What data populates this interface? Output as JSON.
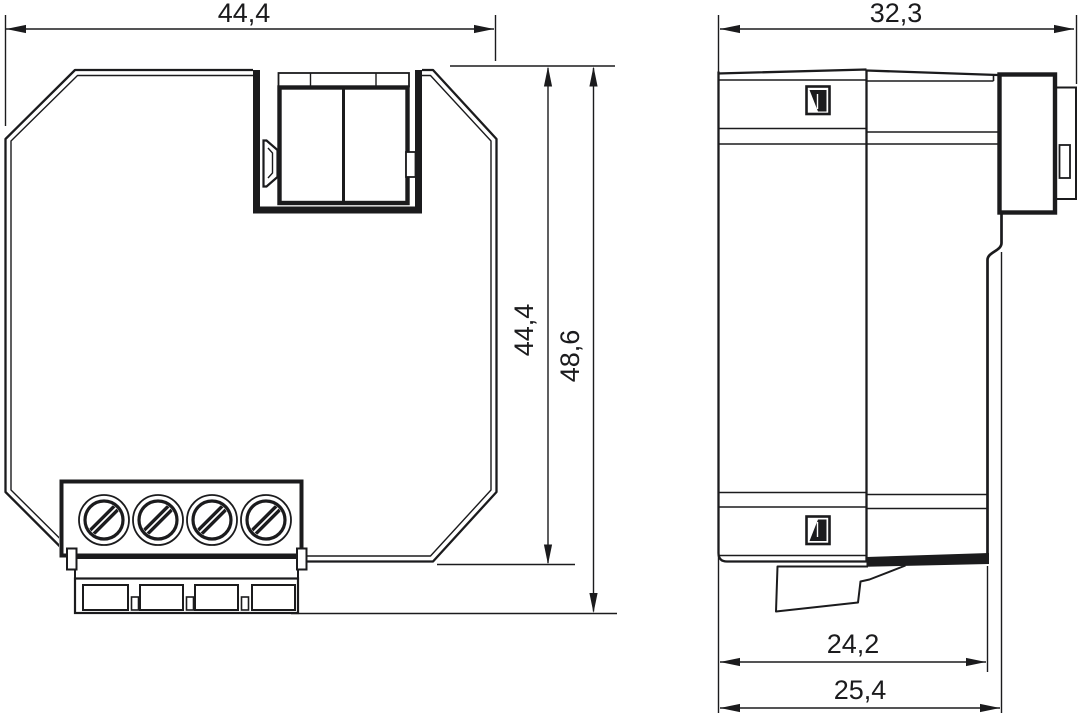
{
  "drawing": {
    "type": "technical-dimension-drawing",
    "views": {
      "front_view": {
        "description": "flush-mount device, octagonal housing with 4-screw terminal block and bus connector recess",
        "dim_width": "44,4",
        "dim_height": "44,4",
        "dim_total_height": "48,6"
      },
      "side_view": {
        "description": "side profile with bus connector block and snap-in foot",
        "dim_depth": "32,3",
        "dim_foot_depth": "24,2",
        "dim_total_depth": "25,4"
      }
    },
    "icons": {
      "programming_flag_top": "square-with-corner-flag",
      "programming_flag_bottom": "square-with-corner-flag"
    },
    "colors": {
      "line": "#1b1b1d",
      "background": "#ffffff"
    }
  }
}
